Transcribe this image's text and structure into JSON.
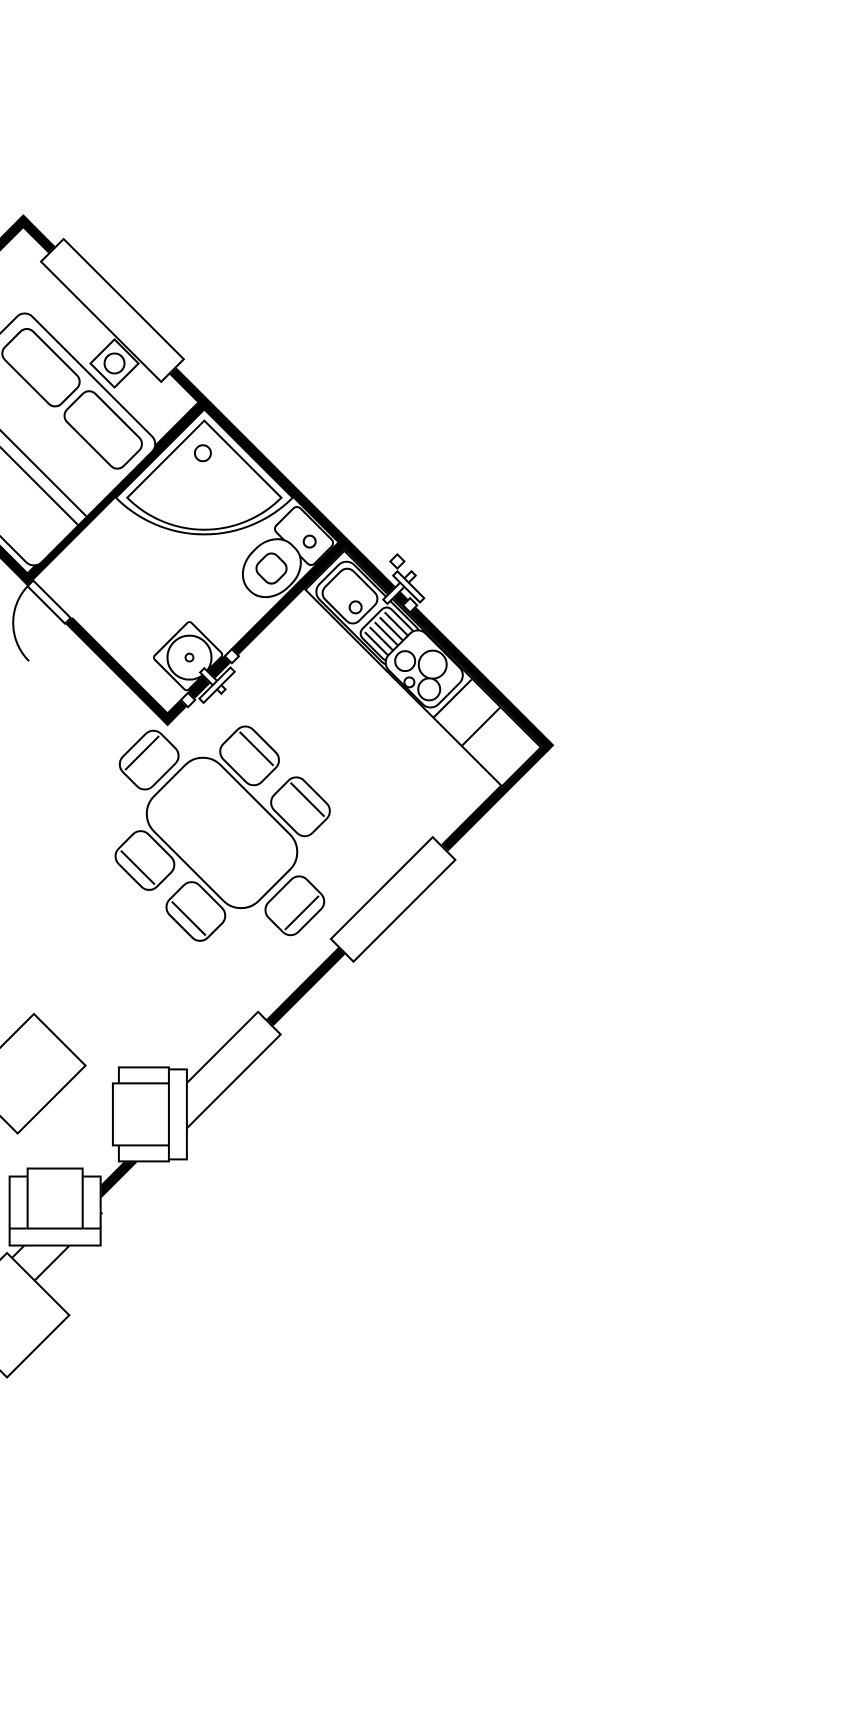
{
  "canvas": {
    "width_px": 855,
    "height_px": 1709,
    "background_color": "#ffffff",
    "line_color": "#000000",
    "wall_color": "#000000"
  },
  "floorplan": {
    "type": "apartment-floor-plan-line-drawing",
    "rotation_deg": 45,
    "visible_text": [],
    "rooms": [
      "bedroom",
      "bathroom",
      "kitchen",
      "living-dining-open-area"
    ],
    "windows_count": 4,
    "doors": [
      "swing-door-with-arc"
    ],
    "fixtures": [
      "double-bed-with-two-pillows-and-blanket-lines",
      "nightstand-with-lamp",
      "corner-shower-with-drain",
      "toilet-with-tank-and-flush-button",
      "washbasin-with-faucet",
      "kitchen-counter",
      "kitchen-sink-with-drainboard-and-faucet",
      "stove-with-four-burners",
      "dining-table-with-six-chairs",
      "coffee-table-rug",
      "armchair-facing-left",
      "armchair-facing-up",
      "corner-of-furniture-at-edge"
    ]
  }
}
